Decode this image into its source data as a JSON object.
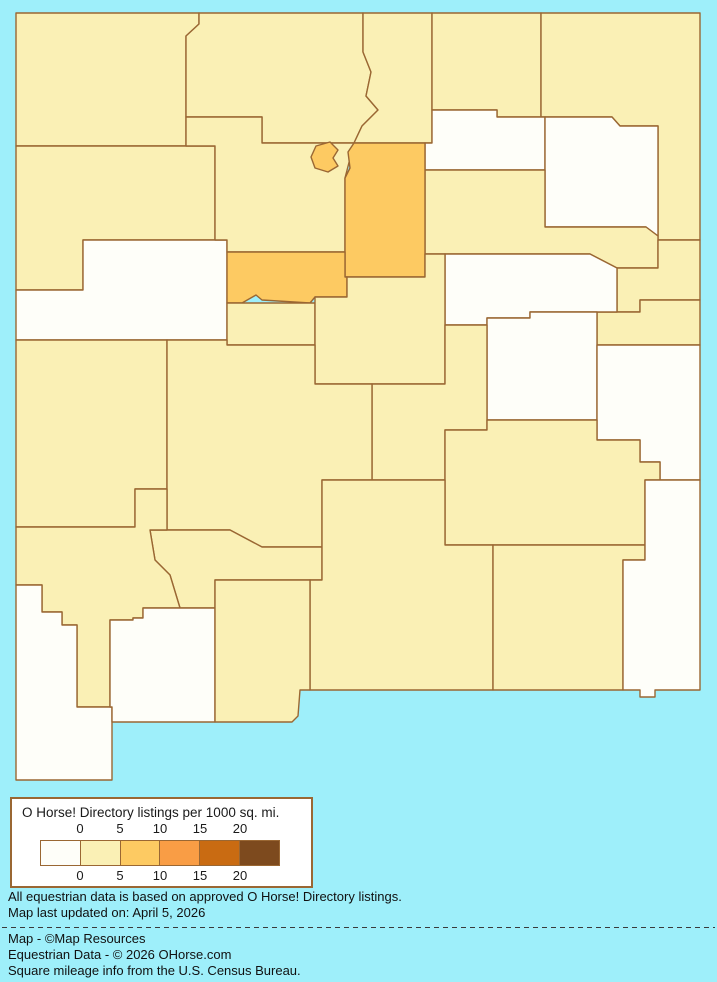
{
  "legend": {
    "title": "O Horse! Directory listings per 1000 sq. mi.",
    "ticks_top": [
      "0",
      "5",
      "10",
      "15",
      "20"
    ],
    "ticks_bottom": [
      "0",
      "5",
      "10",
      "15",
      "20"
    ],
    "swatch_colors": [
      "#FEFEF9",
      "#FAF0B5",
      "#FDCA62",
      "#F99D45",
      "#C96B12",
      "#7D4A1E"
    ]
  },
  "notes": {
    "line1": "All equestrian data is based on approved O Horse! Directory listings.",
    "line2": "Map last updated on: April 5, 2026"
  },
  "credits": {
    "line1": "Map - ©Map Resources",
    "line2": "Equestrian Data - © 2026 OHorse.com",
    "line3": "Square mileage info from the U.S. Census Bureau."
  },
  "map": {
    "background_color": "#9EEFFA",
    "border_color": "#9A6733",
    "class_colors": {
      "c0": "#FEFEF9",
      "c1": "#FAF0B5",
      "c2": "#FDCA62"
    },
    "class_meaning": {
      "c0": "0 listings per 1000 sq mi",
      "c1": "0-5 listings per 1000 sq mi",
      "c2": "5-10 listings per 1000 sq mi"
    },
    "counties": [
      {
        "id": "san-juan",
        "class": "c1",
        "d": "M16,13 L199,13 L199,24 L186,36 L186,146 L16,146 Z"
      },
      {
        "id": "rio-arriba",
        "class": "c1",
        "d": "M199,13 L363,13 L363,52 L371,72 L366,96 L378,110 L362,126 L354,143 L262,143 L262,117 L186,117 L186,36 L199,24 Z"
      },
      {
        "id": "taos",
        "class": "c1",
        "d": "M363,13 L432,13 L432,143 L354,143 L362,126 L378,110 L366,96 L371,72 L363,52 Z"
      },
      {
        "id": "colfax",
        "class": "c1",
        "d": "M432,13 L541,13 L541,117 L497,117 L497,110 L432,110 Z"
      },
      {
        "id": "union",
        "class": "c1",
        "d": "M541,13 L700,13 L700,240 L658,240 L658,126 L620,126 L612,117 L541,117 Z"
      },
      {
        "id": "mora",
        "class": "c0",
        "d": "M432,110 L497,110 L497,117 L545,117 L545,170 L425,170 L425,143 L432,143 Z"
      },
      {
        "id": "harding",
        "class": "c0",
        "d": "M545,117 L612,117 L620,126 L658,126 L658,236 L646,227 L545,227 Z"
      },
      {
        "id": "san-miguel",
        "class": "c1",
        "d": "M425,170 L545,170 L545,227 L646,227 L658,236 L658,268 L617,268 L590,254 L425,254 Z"
      },
      {
        "id": "quay",
        "class": "c1",
        "d": "M658,240 L700,240 L700,300 L640,300 L640,312 L617,312 L617,268 L658,268 Z"
      },
      {
        "id": "curry",
        "class": "c1",
        "d": "M640,300 L700,300 L700,345 L597,345 L597,312 L640,312 Z"
      },
      {
        "id": "guadalupe",
        "class": "c0",
        "d": "M445,254 L590,254 L617,268 L617,312 L530,312 L530,318 L487,318 L487,325 L445,325 Z"
      },
      {
        "id": "de-baca",
        "class": "c0",
        "d": "M487,318 L530,318 L530,312 L597,312 L597,420 L487,420 Z"
      },
      {
        "id": "roosevelt",
        "class": "c0",
        "d": "M597,345 L700,345 L700,480 L660,480 L660,462 L640,462 L640,440 L597,440 Z"
      },
      {
        "id": "mckinley",
        "class": "c1",
        "d": "M16,146 L215,146 L215,240 L83,240 L83,290 L16,290 Z"
      },
      {
        "id": "cibola",
        "class": "c0",
        "d": "M83,240 L227,240 L227,340 L16,340 L16,290 L83,290 Z"
      },
      {
        "id": "sandoval",
        "class": "c1",
        "d": "M186,117 L262,117 L262,143 L354,143 L345,178 L345,252 L227,252 L227,240 L215,240 L215,146 L186,146 Z"
      },
      {
        "id": "santa-fe",
        "class": "c2",
        "d": "M354,143 L425,143 L425,277 L345,277 L345,178 L350,168 L348,152 Z"
      },
      {
        "id": "los-alamos",
        "class": "c2",
        "d": "M316,146 L330,142 L338,150 L333,158 L338,166 L328,172 L315,168 L311,157 Z"
      },
      {
        "id": "bernalillo",
        "class": "c2",
        "d": "M227,252 L345,252 L345,277 L347,277 L347,297 L315,297 L310,303 L262,300 L256,295 L242,303 L227,303 Z"
      },
      {
        "id": "valencia",
        "class": "c1",
        "d": "M227,303 L315,303 L315,345 L227,345 Z"
      },
      {
        "id": "torrance",
        "class": "c1",
        "d": "M347,277 L425,277 L425,254 L445,254 L445,384 L315,384 L315,297 L347,297 Z"
      },
      {
        "id": "lincoln",
        "class": "c1",
        "d": "M372,384 L445,384 L445,325 L487,325 L487,430 L445,430 L445,480 L372,480 Z"
      },
      {
        "id": "chaves",
        "class": "c1",
        "d": "M445,430 L487,430 L487,420 L597,420 L597,440 L640,440 L640,462 L660,462 L660,480 L645,480 L645,545 L445,545 Z"
      },
      {
        "id": "catron",
        "class": "c1",
        "d": "M16,340 L167,340 L167,489 L135,489 L135,527 L16,527 Z"
      },
      {
        "id": "socorro",
        "class": "c1",
        "d": "M167,340 L227,340 L227,345 L315,345 L315,384 L372,384 L372,480 L322,480 L322,547 L262,547 L230,530 L167,530 Z"
      },
      {
        "id": "sierra",
        "class": "c1",
        "d": "M167,530 L230,530 L262,547 L322,547 L322,580 L215,580 L215,608 L180,608 L170,575 L155,560 L150,530 Z"
      },
      {
        "id": "otero",
        "class": "c1",
        "d": "M322,480 L445,480 L445,545 L493,545 L493,690 L310,690 L310,580 L322,580 Z"
      },
      {
        "id": "eddy",
        "class": "c1",
        "d": "M493,545 L645,545 L645,560 L623,560 L623,690 L493,690 Z"
      },
      {
        "id": "lea",
        "class": "c0",
        "d": "M660,480 L700,480 L700,690 L655,690 L655,697 L640,697 L640,690 L623,690 L623,560 L645,560 L645,480 Z"
      },
      {
        "id": "grant",
        "class": "c1",
        "d": "M16,527 L135,527 L135,489 L167,489 L167,530 L150,530 L155,560 L170,575 L180,608 L143,608 L143,618 L133,618 L133,620 L110,620 L110,707 L77,707 L77,625 L62,625 L62,612 L42,612 L42,585 L16,585 Z"
      },
      {
        "id": "hidalgo",
        "class": "c0",
        "d": "M16,585 L42,585 L42,612 L62,612 L62,625 L77,625 L77,707 L112,707 L112,780 L16,780 Z"
      },
      {
        "id": "luna",
        "class": "c0",
        "d": "M133,618 L143,618 L143,608 L215,608 L215,722 L112,722 L112,707 L110,707 L110,620 L133,620 Z"
      },
      {
        "id": "dona-ana",
        "class": "c1",
        "d": "M215,580 L310,580 L310,690 L300,690 L298,716 L292,722 L215,722 Z"
      }
    ]
  }
}
